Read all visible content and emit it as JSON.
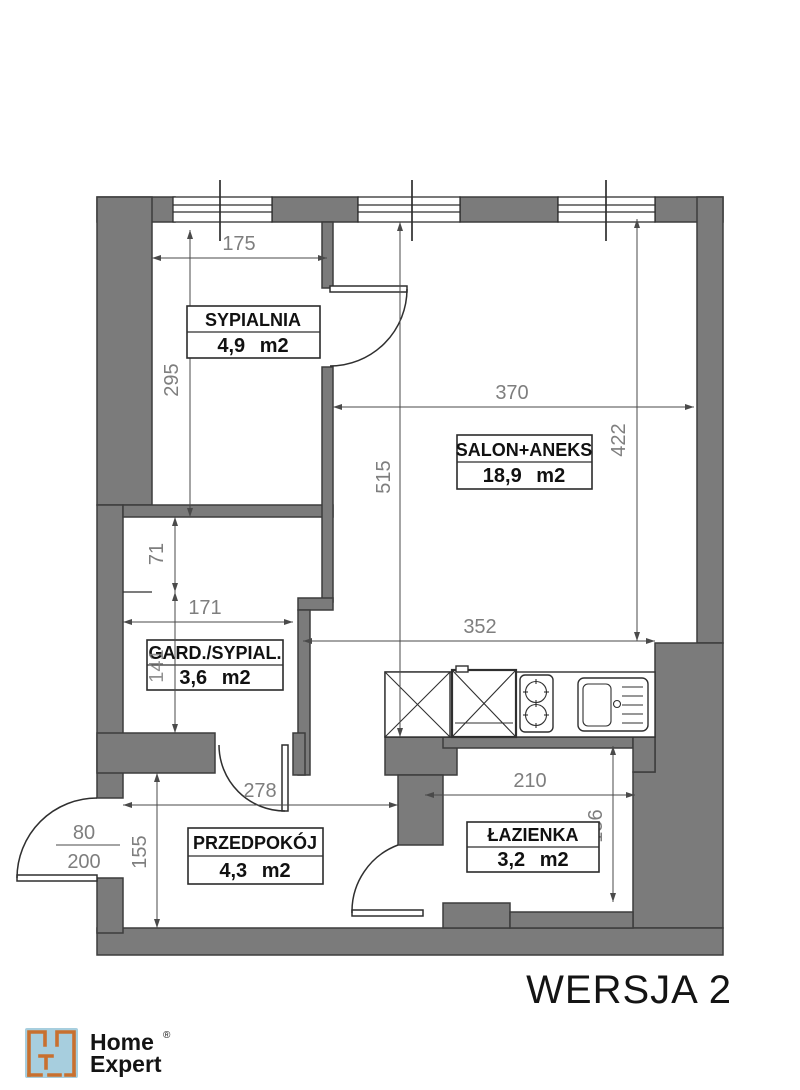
{
  "plan": {
    "version_label": "WERSJA 2",
    "rooms": [
      {
        "name": "SYPIALNIA",
        "area": "4,9 m2"
      },
      {
        "name": "SALON+ANEKS",
        "area": "18,9 m2"
      },
      {
        "name": "GARD./SYPIAL.",
        "area": "3,6 m2"
      },
      {
        "name": "PRZEDPOKÓJ",
        "area": "4,3 m2"
      },
      {
        "name": "ŁAZIENKA",
        "area": "3,2 m2"
      }
    ],
    "dimensions": {
      "sypialnia_width": "175",
      "sypialnia_height": "295",
      "salon_width": "370",
      "salon_right_height": "422",
      "salon_full_height": "515",
      "gard_top_offset": "71",
      "gard_width": "171",
      "gard_height": "141",
      "kitchen_width": "352",
      "przedpokoj_width": "278",
      "przedpokoj_height": "155",
      "lazienka_width": "210",
      "lazienka_height": "156",
      "entry_door_width": "80",
      "entry_door_height": "200"
    }
  },
  "logo": {
    "brand_line1": "Home",
    "brand_line2": "Expert",
    "registered_mark": "®"
  },
  "colors": {
    "wall_gray": "#7b7b7b",
    "dimension_text": "#7e7e7e",
    "logo_orange": "#c8702f",
    "logo_blue": "#a7cede"
  }
}
